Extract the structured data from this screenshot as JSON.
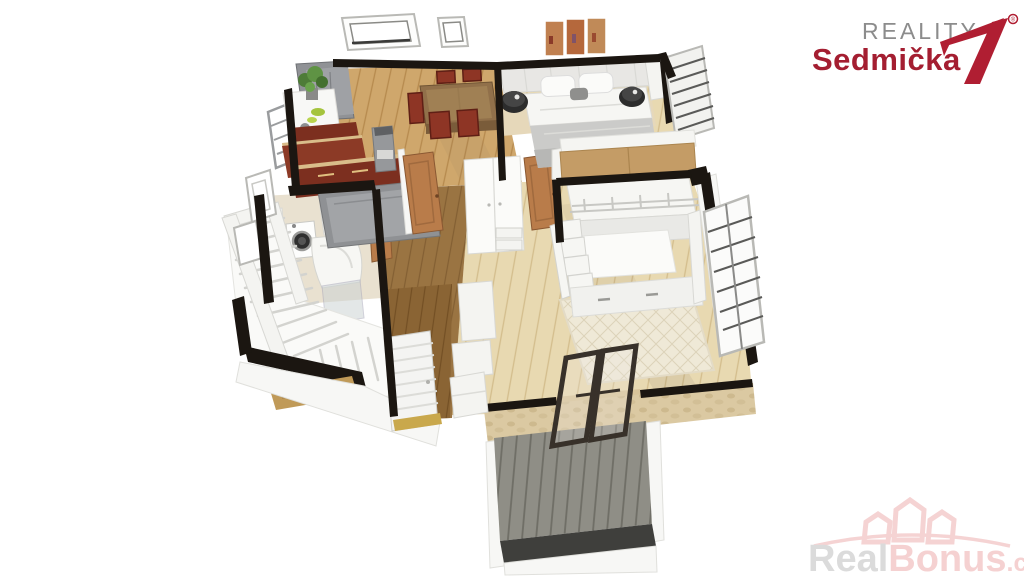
{
  "page": {
    "background_color": "#ffffff",
    "width": 1024,
    "height": 576,
    "content_type": "3d-floor-plan-render"
  },
  "branding": {
    "agency_logo": {
      "line1": "REALITY",
      "line2": "Sedmička",
      "registered_mark": "®",
      "line1_color": "#8c8c8c",
      "line2_color": "#a41e31",
      "seven_color": "#b01e32"
    },
    "watermark": {
      "part1": "Real",
      "part2": "Bonus",
      "part3": ".cz",
      "part1_color": "#d8d8d8",
      "part2_color": "#f4cdcd",
      "icon": "houses-arc-icon",
      "icon_color": "#f4cfcf"
    }
  },
  "floorplan": {
    "view": "isometric-3d-top-down",
    "colors": {
      "wall_dark": "#1b1611",
      "wall_white": "#f7f7f5",
      "floor_light_wood": "#e8d9b1",
      "floor_mid_wood": "#cfa76c",
      "floor_dark_wood": "#9a7442",
      "floor_entry_wood": "#8a6434",
      "bathroom_tile": "#e9e1d0",
      "kitchen_cabinet_red": "#7c2f1f",
      "cabinet_gray": "#909296",
      "dining_table_wood": "#91704a",
      "chair_red": "#8e3525",
      "bed_linen_white": "#f6f6f3",
      "blanket_gray": "#cbcbc9",
      "nightstand_black": "#2c2c2c",
      "kids_rug_cream": "#efe9d7",
      "door_wood": "#b97c4a",
      "deck_gray": "#8f8e86",
      "stone_wall": "#dbc9a2",
      "glass_door_frame": "#38312a",
      "plant_green": "#5f9344"
    },
    "elements": [
      "skylight-windows",
      "kitchen-dining",
      "dining-table",
      "bedroom",
      "double-bed",
      "wall-art-triptych",
      "kids-room",
      "loft-bed",
      "bathroom",
      "washing-machine",
      "shower",
      "staircase",
      "hallway",
      "wardrobe",
      "wood-doors",
      "entry-door",
      "terrace-deck",
      "balcony-glass-doors",
      "stone-exterior-wall",
      "window-shutters"
    ]
  }
}
